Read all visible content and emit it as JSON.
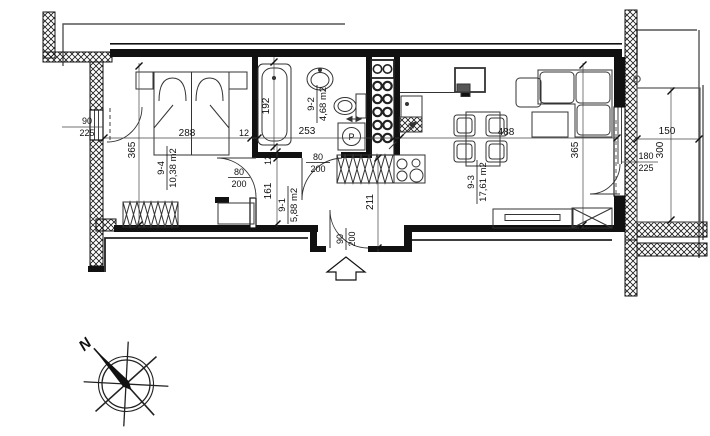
{
  "rooms": [
    {
      "number": "9-4",
      "area": "10,38 m2"
    },
    {
      "number": "9-1",
      "area": "5,88 m2"
    },
    {
      "number": "9-2",
      "area": "4,68 m2"
    },
    {
      "number": "9-3",
      "area": "17,61 m2"
    }
  ],
  "dimensions": {
    "bedroom_width": "288",
    "bedroom_depth": "365",
    "wall_thickness_a": "12",
    "wall_thickness_b": "12",
    "bathroom_width": "253",
    "bathtub_length": "192",
    "hall_depth": "161",
    "hall_width": "211",
    "living_width": "488",
    "living_depth": "365",
    "balcony_width": "150",
    "balcony_depth": "300"
  },
  "openings": {
    "bedroom_window_width": "90",
    "bedroom_window_height": "225",
    "bedroom_door_width": "80",
    "bedroom_door_height": "200",
    "bathroom_door_width": "80",
    "bathroom_door_height": "200",
    "entrance_door_width": "90",
    "entrance_door_height": "200",
    "balcony_door_width": "180",
    "balcony_door_height": "225"
  },
  "symbols": {
    "washing_machine": "P",
    "compass_north": "N"
  }
}
